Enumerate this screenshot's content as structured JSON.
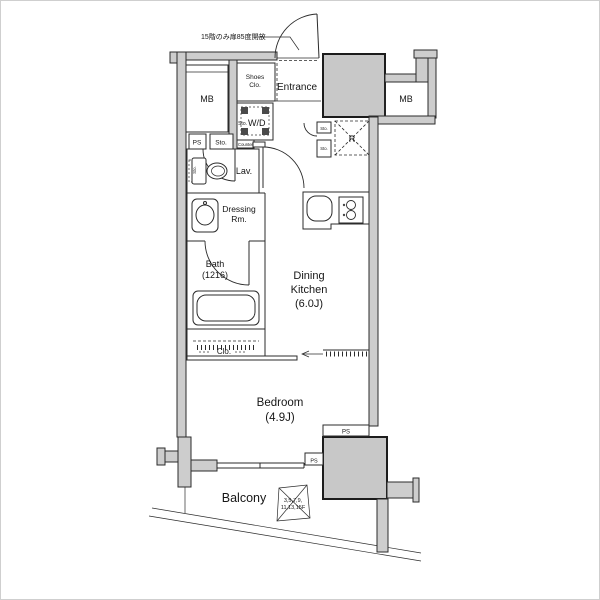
{
  "plan": {
    "annotation_top": "15階のみ扉85度開放",
    "labels": {
      "mb_left": "MB",
      "mb_right": "MB",
      "shoes_1": "Shoes",
      "shoes_2": "Clo.",
      "entrance": "Entrance",
      "wd_sto": "Sto.",
      "wd": "W/D",
      "ps_top": "PS",
      "sto_top": "Sto.",
      "counter": "Counter",
      "lav": "Lav.",
      "sto_lav": "Sto.",
      "dressing_1": "Dressing",
      "dressing_2": "Rm.",
      "bath_1": "Bath",
      "bath_2": "(1216)",
      "dk_1": "Dining",
      "dk_2": "Kitchen",
      "dk_3": "(6.0J)",
      "fridge": "R",
      "sto_r1": "Sto.",
      "sto_r2": "Sto.",
      "closet": "Clo.",
      "bedroom_1": "Bedroom",
      "bedroom_2": "(4.9J)",
      "ps_right": "PS",
      "ps_small": "PS",
      "balcony": "Balcony",
      "hatch_1": "3,5,7,9,",
      "hatch_2": "11,13,15F"
    },
    "colors": {
      "wall_fill": "#cdcdcd",
      "shaft_fill": "#c8c8c8",
      "line": "#2b2b2b",
      "background": "#ffffff"
    }
  }
}
